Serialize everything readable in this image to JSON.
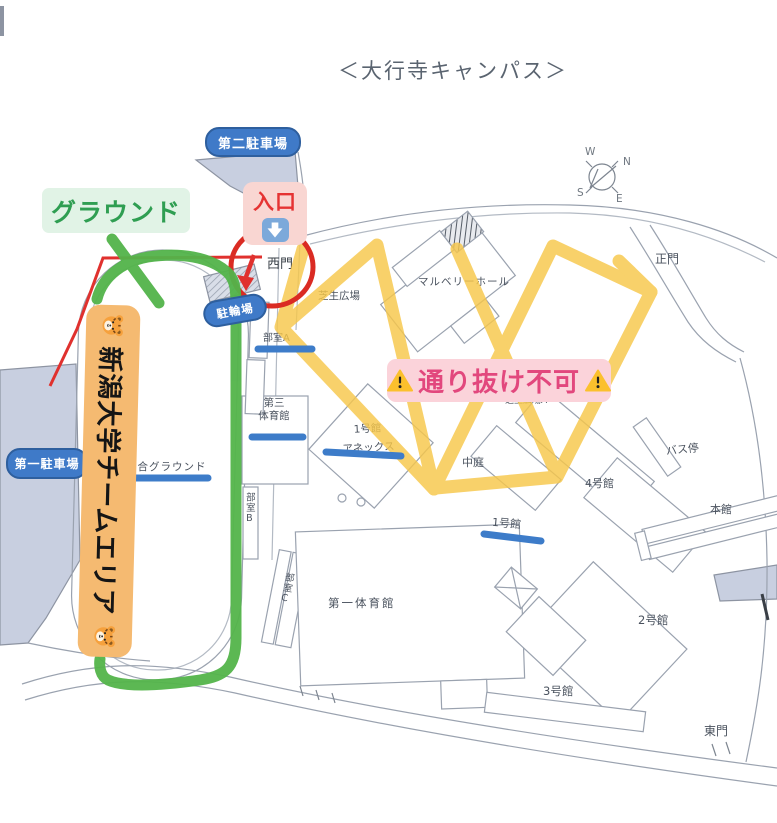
{
  "title": "＜大行寺キャンパス＞",
  "compass": {
    "n": "N",
    "e": "E",
    "s": "S",
    "w": "W"
  },
  "overlays": {
    "ground_label": "グラウンド",
    "entrance_label": "入口",
    "no_pass_label": "通り抜け不可",
    "team_area_label": "新潟大学チームエリア",
    "icons": {
      "tiger": "tiger-face",
      "warning": "warning-triangle",
      "down_arrow": "down-arrow"
    }
  },
  "parking": {
    "second": "第二駐車場",
    "first": "第一駐車場",
    "bicycle": "駐輪場"
  },
  "gates": {
    "west": "西門",
    "main": "正門",
    "east": "東門"
  },
  "buildings": {
    "mulberry_hall": "マルベリーホール",
    "lawn_plaza": "芝生広場",
    "lawn_plaza_a": "芝生広場A",
    "courtyard": "中庭",
    "gym3_line1": "第三",
    "gym3_line2": "体育館",
    "annex_line1": "1号館",
    "annex_line2": "アネックス",
    "bldg1": "1号館",
    "bldg2": "2号館",
    "bldg3": "3号館",
    "bldg4": "4号館",
    "bus_stop": "バス停",
    "main_bldg": "本館",
    "gym1": "第一体育館",
    "general_ground": "総合グラウンド",
    "club_a": "部室A",
    "club_b": "部室B",
    "club_c": "部室C"
  },
  "colors": {
    "route_green": "#53B44A",
    "route_red": "#E0312E",
    "hatch_yellow": "#F7C74A",
    "underline_blue": "#3D7CC9",
    "pill_blue": "#3F7AC8",
    "banner_orange": "#F5BA71",
    "no_pass_bg": "#FBD3DA",
    "no_pass_text": "#E2477D",
    "ground_bg": "#E1F3E6",
    "ground_text": "#2F9E52",
    "entrance_bg": "#F9D6D2",
    "entrance_text": "#E53333",
    "parking_fill": "#C8CFE0",
    "map_line": "#9AA2AF"
  }
}
